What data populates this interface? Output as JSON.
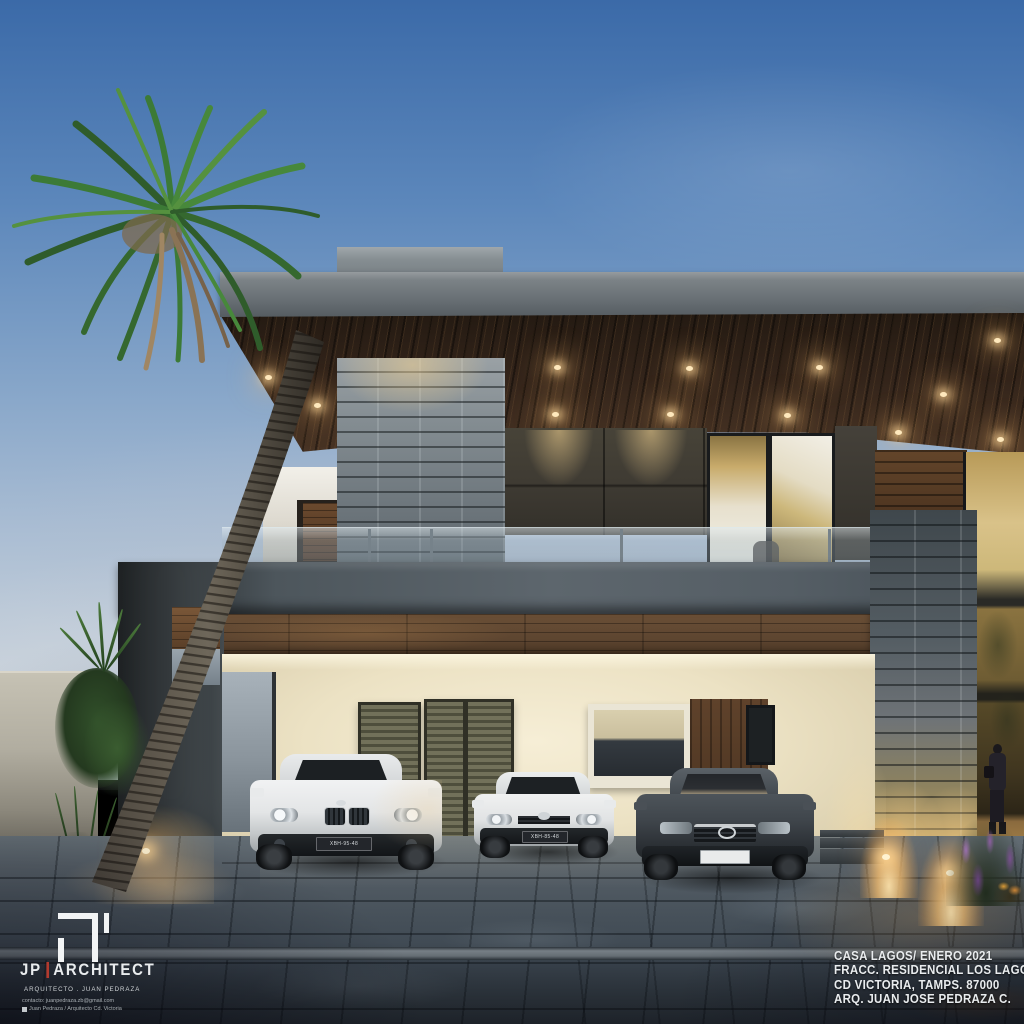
{
  "branding": {
    "name_primary": "JP",
    "name_secondary": "ARCHITECT",
    "subtitle": "ARQUITECTO . JUAN PEDRAZA",
    "contact_line": "contacto: juanpedraza.zb@gmail.com",
    "social_line": "Juan Pedraza / Arquitecto Cd. Victoria"
  },
  "project_info": {
    "line1": "CASA LAGOS/ ENERO 2021",
    "line2": "FRACC. RESIDENCIAL LOS LAGOS",
    "line3": "CD VICTORIA, TAMPS. 87000",
    "line4": "ARQ. JUAN JOSE PEDRAZA C."
  },
  "vehicles": {
    "suv_plate": "XBH-95-48",
    "hatchback_plate": "XBH-85-48"
  },
  "theme": {
    "sky_top": "#3b6aa8",
    "sky_mid": "#87a6c9",
    "sky_horizon": "#cdd5dc",
    "fascia_gray": "#6b7277",
    "charcoal": "#33383b",
    "soffit_wood": "#33241a",
    "beam_wood": "#5d4530",
    "stone_gray": "#7e878c",
    "dark_tile": "#3f3b33",
    "cream_wall": "#ece2c4",
    "glass_gold": "#c4a35d",
    "pavement": "#47515a",
    "accent_red": "#b23a2e",
    "text_white": "#e9ecee",
    "light_warm": "#f5d9a0"
  }
}
